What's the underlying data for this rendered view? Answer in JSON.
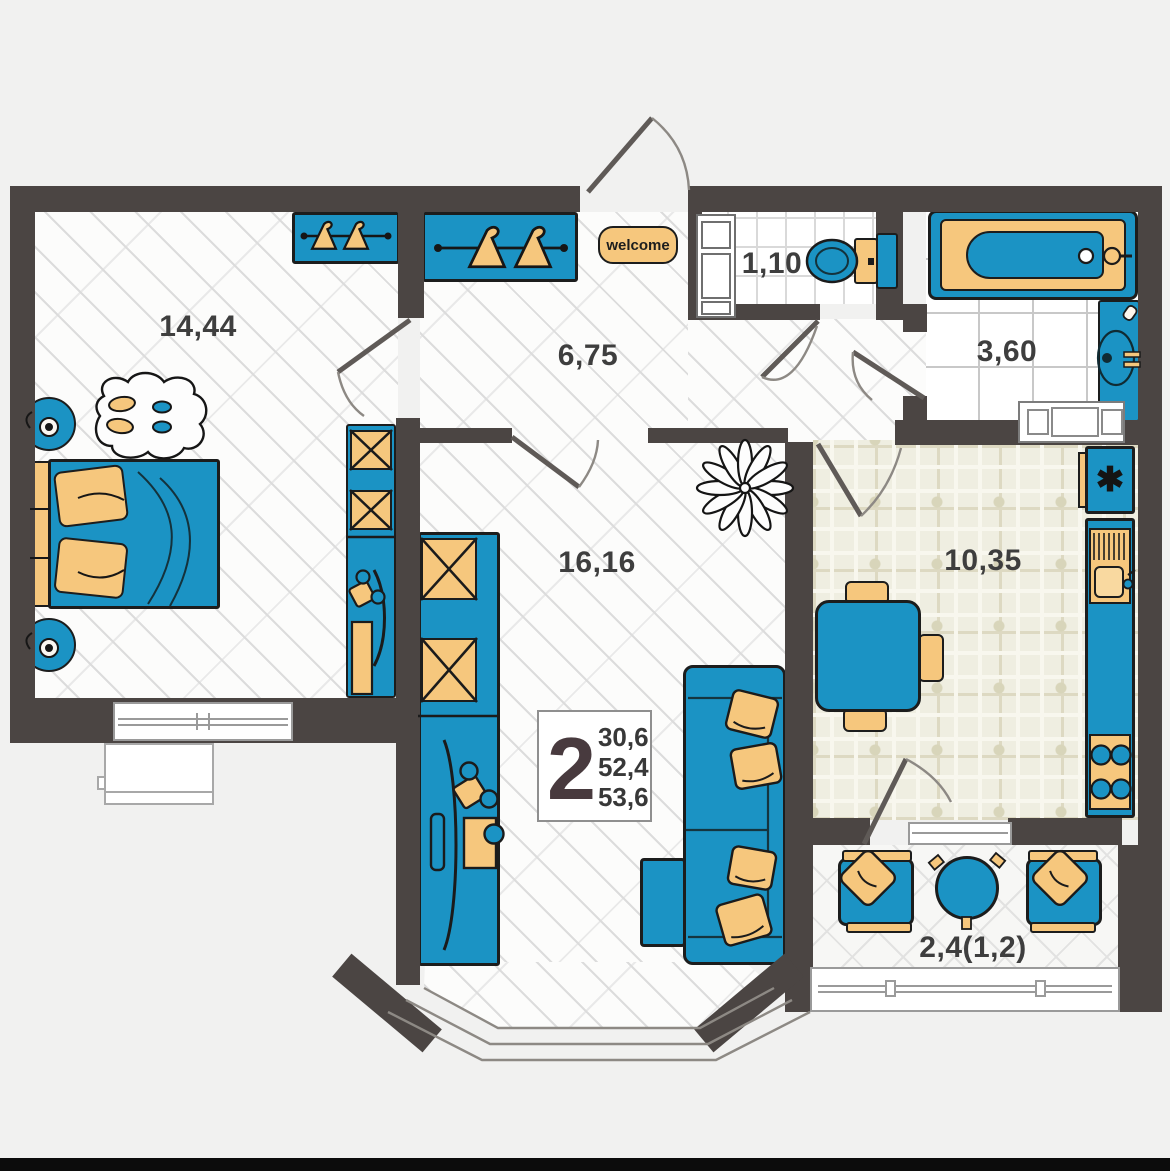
{
  "rooms": {
    "bedroom": {
      "area_label": "14,44"
    },
    "hallway": {
      "area_label": "6,75"
    },
    "wc": {
      "area_label": "1,10"
    },
    "bathroom": {
      "area_label": "3,60"
    },
    "living_room": {
      "area_label": "16,16"
    },
    "kitchen": {
      "area_label": "10,35"
    },
    "balcony": {
      "area_label": "2,4(1,2)"
    }
  },
  "spec_badge": {
    "rooms_count": "2",
    "living_area": "30,6",
    "apartment_area": "52,4",
    "total_area": "53,6"
  },
  "entry_mat": {
    "text": "welcome"
  },
  "icons": {
    "fridge_defrost_icon": "✱"
  },
  "colors": {
    "wall": "#4b4543",
    "furniture_blue": "#1b93c4",
    "furniture_tan": "#f6c77d",
    "outline": "#1c1d1d",
    "background": "#f1f1f0",
    "kitchen_tile": "#efeee1"
  }
}
